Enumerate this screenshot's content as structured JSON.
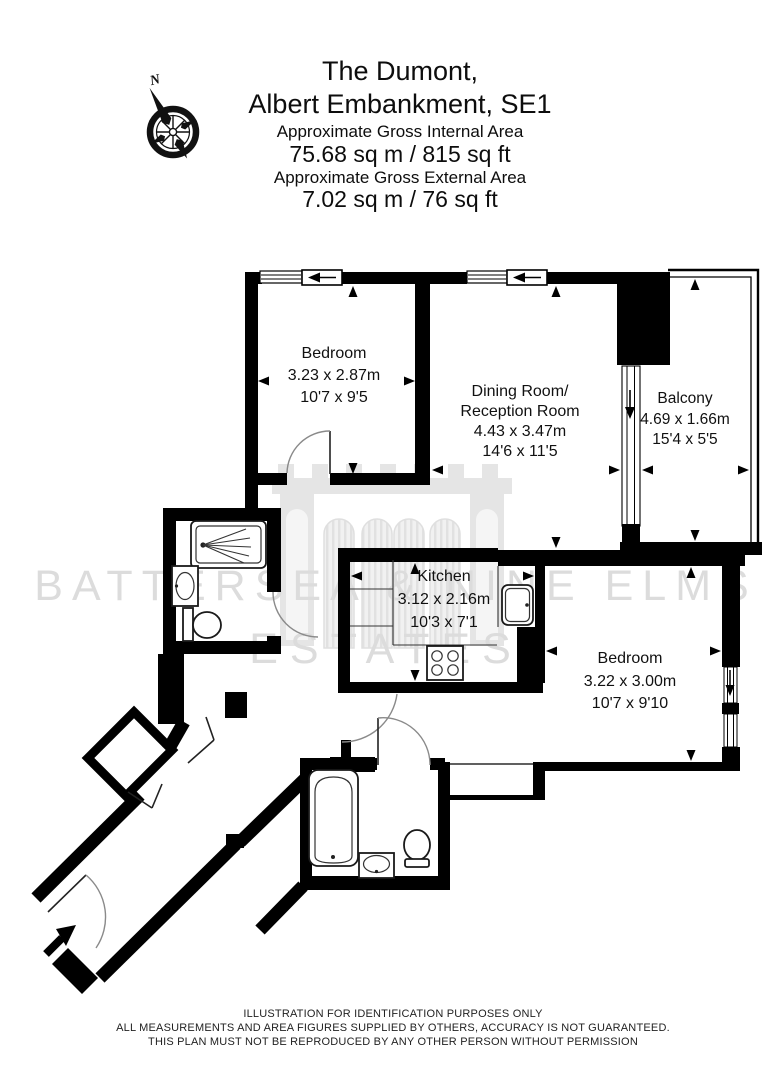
{
  "header": {
    "title_line1": "The Dumont,",
    "title_line2": "Albert Embankment, SE1",
    "internal_area_label": "Approximate Gross Internal Area",
    "internal_area_value": "75.68 sq m / 815 sq ft",
    "external_area_label": "Approximate Gross External Area",
    "external_area_value": "7.02 sq m / 76 sq ft",
    "compass_north": "N"
  },
  "floorplan": {
    "rooms": {
      "bedroom1": {
        "label": "Bedroom",
        "metric": "3.23 x 2.87m",
        "imperial": "10'7 x 9'5"
      },
      "dining": {
        "label1": "Dining Room/",
        "label2": "Reception Room",
        "metric": "4.43 x 3.47m",
        "imperial": "14'6 x 11'5"
      },
      "balcony": {
        "label": "Balcony",
        "metric": "4.69 x 1.66m",
        "imperial": "15'4 x 5'5"
      },
      "kitchen": {
        "label": "Kitchen",
        "metric": "3.12 x 2.16m",
        "imperial": "10'3 x 7'1"
      },
      "bedroom2": {
        "label": "Bedroom",
        "metric": "3.22 x 3.00m",
        "imperial": "10'7 x 9'10"
      }
    },
    "fixtures": [
      "shower-tray",
      "basin",
      "wc",
      "bathtub",
      "basin",
      "wc",
      "kitchen-sink",
      "hob",
      "wardrobe"
    ],
    "colors": {
      "walls": "#000000",
      "watermark": "#dcdcdc"
    }
  },
  "watermark": {
    "line1": "BATTERSEA & NINE ELMS",
    "line2": "ESTATES"
  },
  "footer": {
    "line1": "ILLUSTRATION FOR IDENTIFICATION PURPOSES ONLY",
    "line2": "ALL MEASUREMENTS AND AREA FIGURES SUPPLIED BY OTHERS, ACCURACY IS NOT GUARANTEED.",
    "line3": "THIS PLAN MUST NOT BE REPRODUCED BY ANY OTHER PERSON WITHOUT PERMISSION"
  }
}
